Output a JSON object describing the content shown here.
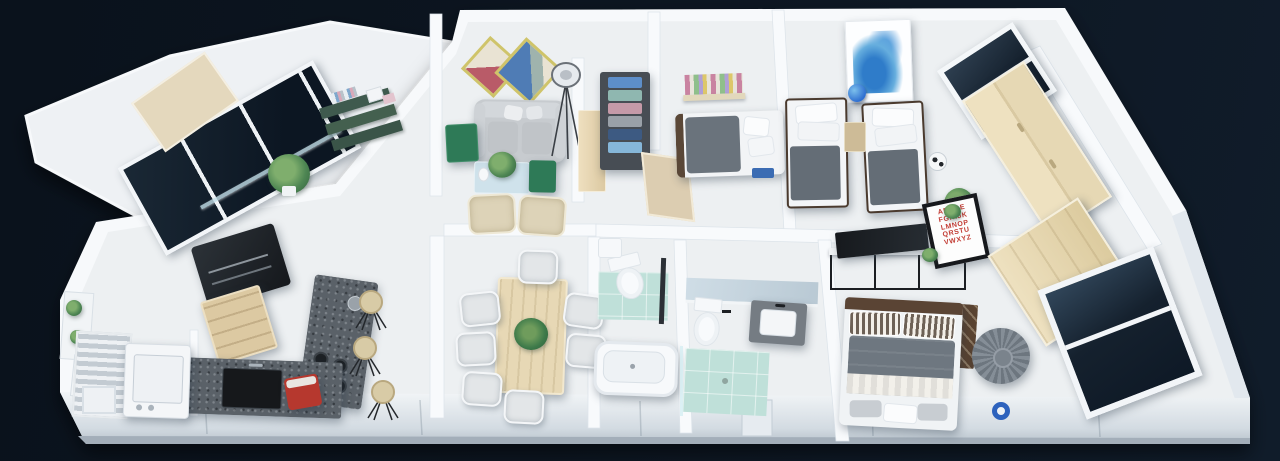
{
  "scene": {
    "description": "3D isometric cutaway render of a furnished 3-bedroom apartment floor plan, viewed from above on a dark navy background",
    "style": "photoreal architectural dollhouse render, no UI text except an alphabet wall poster"
  },
  "palette": {
    "background_dark": "#0a121c",
    "background_light": "#101c2a",
    "wall_white": "#f8fafc",
    "floor_white": "#edf0f2",
    "teal_bathroom_floor": "#bfe0d9",
    "wood_light": "#e6d8b4",
    "wood_dark": "#5a4434",
    "counter_dark_speckled": "#5a6168",
    "textile_gray": "#6b747d",
    "accent_red": "#b6382e",
    "accent_green_table": "#2e7a57",
    "accent_blue_art": "#2f7cc9",
    "shelf_green": "#3f5a4e"
  },
  "master_bedroom_poster": {
    "text": "ABCDE\nFGHIJK\nLMNOP\nQRSTU\nVWXYZ",
    "letter_color": "#c23b33",
    "frame_color": "#17191d"
  },
  "rooms": [
    {
      "name": "terrace",
      "items": [
        "glass-balustrade",
        "terrace-door-panel",
        "planter-boxes",
        "plants"
      ]
    },
    {
      "name": "entry-hall",
      "items": [
        "green-string-shelf-with-books",
        "glass-partition",
        "potted-plant"
      ]
    },
    {
      "name": "living-room",
      "items": [
        "diamond-geometric-wall-art",
        "gray-sofa-with-pillows",
        "tripod-floor-lamp",
        "green-side-table",
        "glass-coffee-table-with-plant",
        "two-beige-armchairs"
      ]
    },
    {
      "name": "hallway-closet",
      "items": [
        "open-wardrobe-with-folded-clothes",
        "tall-beige-cabinet",
        "beige-hall-door"
      ]
    },
    {
      "name": "bedroom-one",
      "items": [
        "colorful-wall-bookshelf",
        "single-bed-gray-blanket",
        "blue-underbed-storage"
      ]
    },
    {
      "name": "kids-bedroom",
      "items": [
        "blue-watercolor-splash-art",
        "twin-bed-left",
        "twin-bed-right",
        "nightstand",
        "blue-globe",
        "corner-window",
        "light-wood-sliding-closet",
        "soccer-ball",
        "potted-plant"
      ]
    },
    {
      "name": "kitchen",
      "items": [
        "dark-refrigerator",
        "wood-cabinet",
        "speckled-island-with-cooktop",
        "speckled-counter-with-black-sink",
        "red-countertop-appliance",
        "three-bar-stools"
      ]
    },
    {
      "name": "laundry",
      "items": [
        "drying-rack",
        "washing-machine",
        "corner-basket"
      ]
    },
    {
      "name": "dining-room",
      "items": [
        "light-wood-dining-table",
        "seven-white-chairs",
        "table-plant"
      ]
    },
    {
      "name": "bathroom-one",
      "items": [
        "toilet",
        "small-sink",
        "shower-column",
        "bathtub",
        "teal-tile-floor"
      ]
    },
    {
      "name": "bathroom-two",
      "items": [
        "mirror-strip",
        "toilet",
        "dark-vanity-with-basin",
        "teal-shower-floor",
        "glass-screen"
      ]
    },
    {
      "name": "master-bedroom",
      "items": [
        "black-frame-tv-unit",
        "flat-tv",
        "alphabet-poster",
        "small-plants",
        "wood-bench",
        "double-bed-striped-pillows",
        "gray-knitted-pouf",
        "blue-ring-decor",
        "light-wood-wardrobe-panel",
        "large-dark-window"
      ]
    }
  ]
}
